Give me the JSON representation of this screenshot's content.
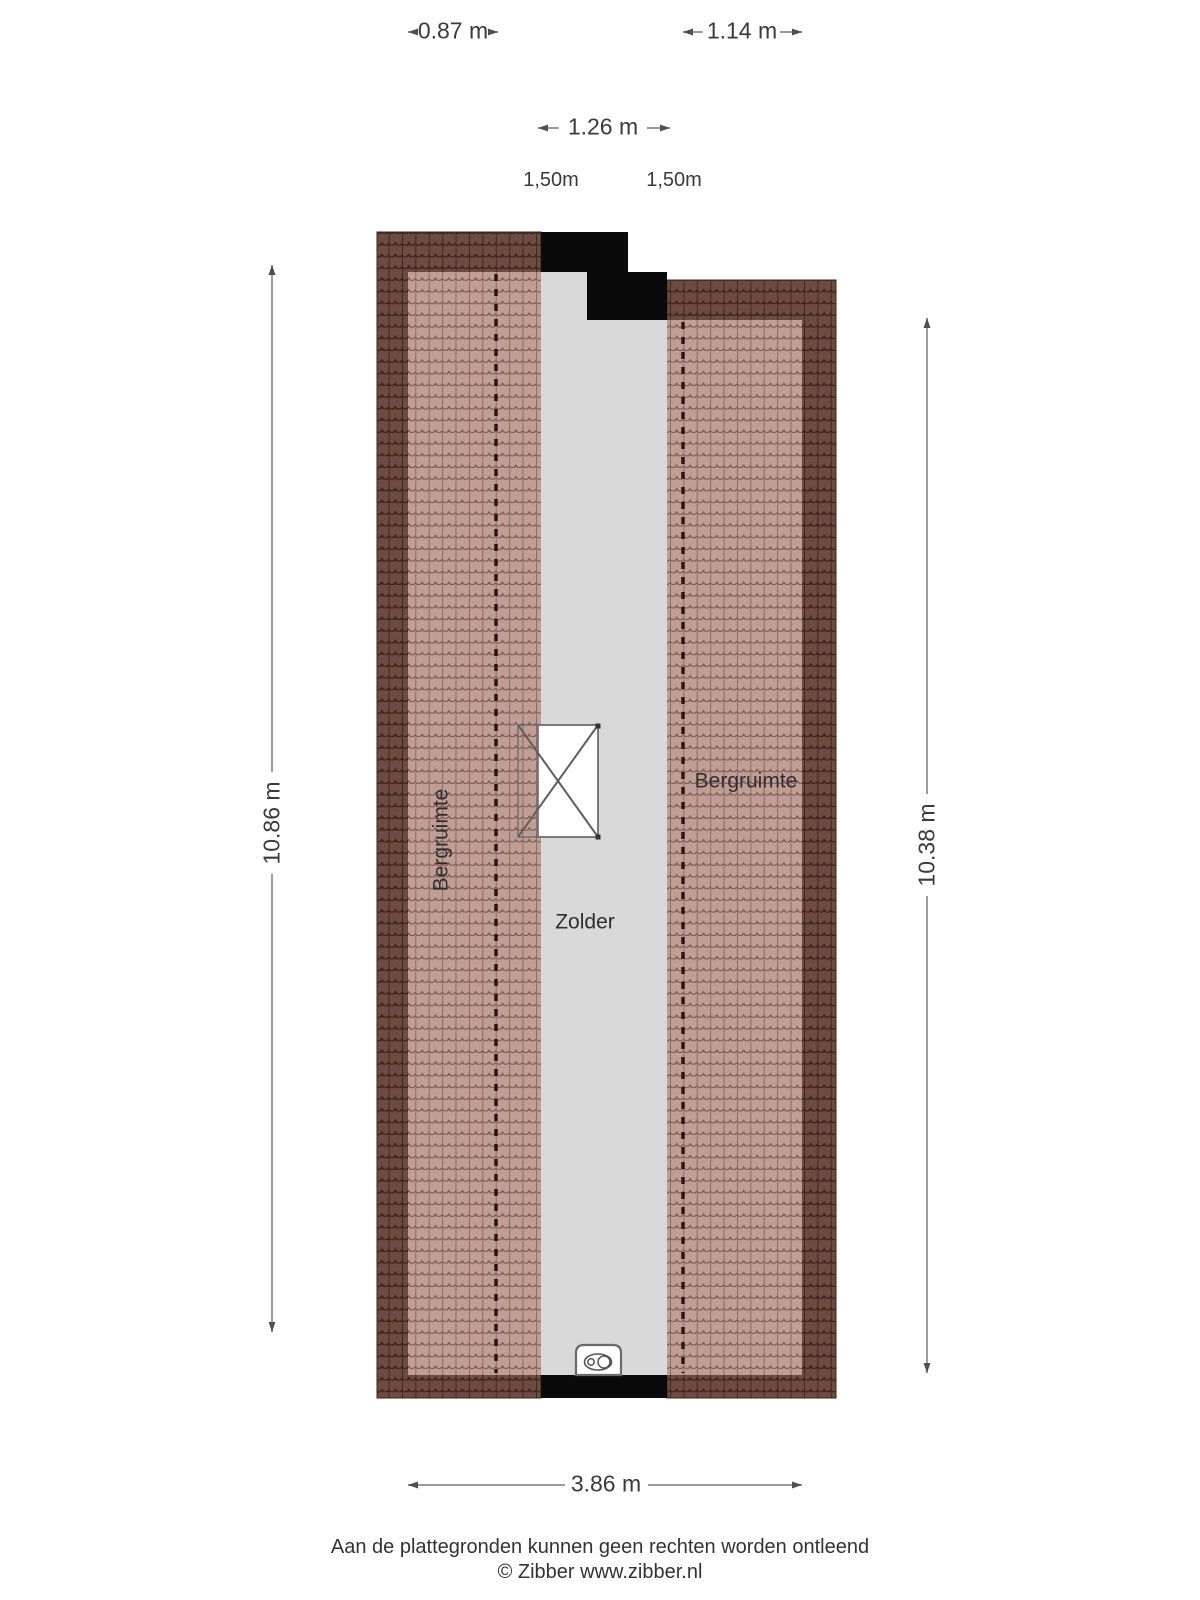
{
  "rooms": {
    "storage_left": "Bergruimte",
    "attic": "Zolder",
    "storage_right": "Bergruimte"
  },
  "dimensions": {
    "top_left_width": "0.87 m",
    "top_right_width": "1.14 m",
    "stair_opening_width": "1.26 m",
    "headroom_left": "1,50m",
    "headroom_right": "1,50m",
    "left_height": "10.86 m",
    "right_height": "10.38 m",
    "bottom_width": "3.86 m"
  },
  "footer": {
    "disclaimer": "Aan de plattegronden kunnen geen rechten worden ontleend",
    "copyright": "© Zibber www.zibber.nl"
  },
  "colors": {
    "roof_dark": "#6E4B41",
    "roof_dark_line": "#3B241D",
    "roof_light": "#C09E96",
    "roof_light_line": "#7D594E",
    "floor": "#D9D9D9",
    "wall": "#0A0A0A",
    "dashed_line": "#261813",
    "dim_line": "#9B9B9B",
    "dim_arrow": "#4F4F4F",
    "text": "#3A3A3A"
  }
}
